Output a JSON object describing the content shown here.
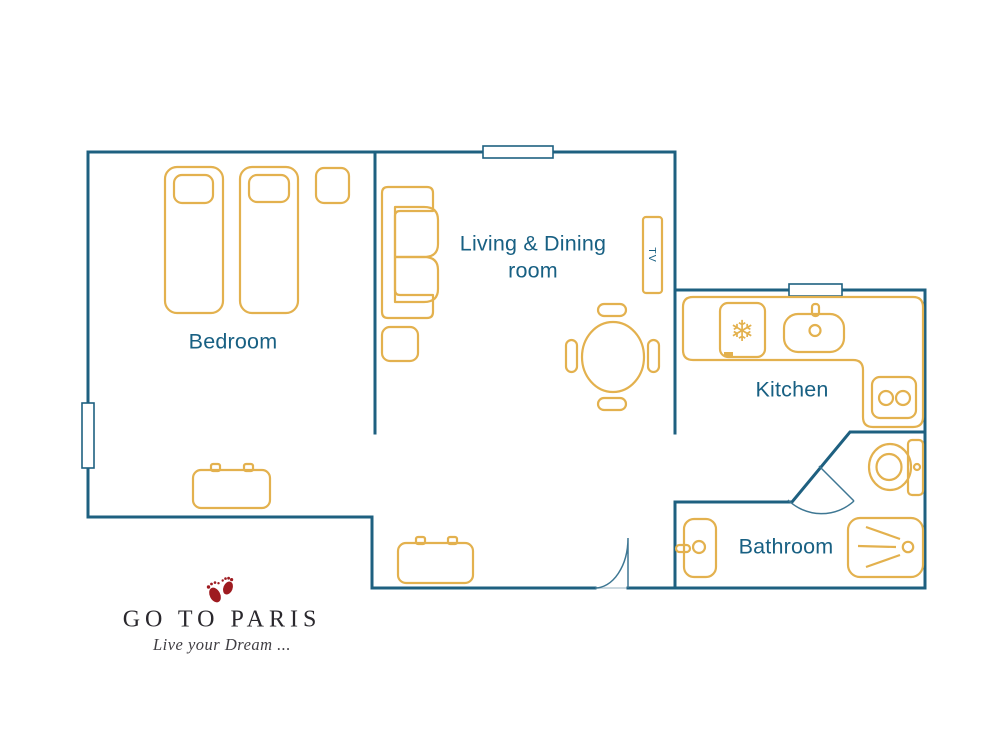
{
  "colors": {
    "wall": "#1e6080",
    "furniture": "#e3b14e",
    "room_label": "#186083",
    "door": "#3e7793",
    "threshold": "#ccd9e0",
    "logo_text": "#2a282d",
    "tagline_text": "#403e43",
    "footprint": "#9e1b20",
    "background": "#ffffff"
  },
  "rooms": {
    "bedroom": {
      "label": "Bedroom"
    },
    "living_dining": {
      "label_line1": "Living & Dining",
      "label_line2": "room"
    },
    "kitchen": {
      "label": "Kitchen"
    },
    "bathroom": {
      "label": "Bathroom"
    }
  },
  "furniture": {
    "tv_label": "TV",
    "fridge_snowflake_icon": "❄"
  },
  "logo": {
    "title": "GO TO PARIS",
    "tagline": "Live your Dream ..."
  }
}
